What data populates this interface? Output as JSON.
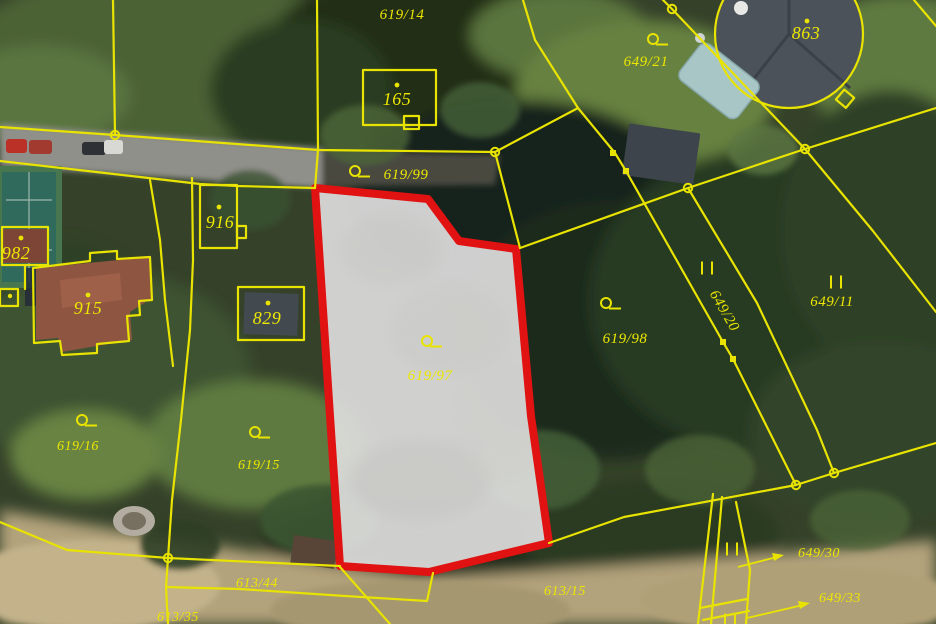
{
  "map_type": "cadastral-parcel-map-over-aerial-photo",
  "colors": {
    "parcel_line_yellow": "#e8e300",
    "label_yellow": "#ece600",
    "highlight_border_red": "#e01212",
    "highlight_fill": "#dddddb"
  },
  "highlight": {
    "parcel_number": "619/97"
  },
  "labels": [
    {
      "text": "619/14",
      "type": "parcel"
    },
    {
      "text": "165",
      "type": "building"
    },
    {
      "text": "649/21",
      "type": "parcel"
    },
    {
      "text": "863",
      "type": "building"
    },
    {
      "text": "619/99",
      "type": "parcel"
    },
    {
      "text": "916",
      "type": "building"
    },
    {
      "text": "982",
      "type": "building"
    },
    {
      "text": "915",
      "type": "building"
    },
    {
      "text": "829",
      "type": "building"
    },
    {
      "text": "619/98",
      "type": "parcel"
    },
    {
      "text": "649/20",
      "type": "parcel",
      "rotated": true
    },
    {
      "text": "649/11",
      "type": "parcel"
    },
    {
      "text": "619/97",
      "type": "parcel-highlighted"
    },
    {
      "text": "619/16",
      "type": "parcel"
    },
    {
      "text": "619/15",
      "type": "parcel"
    },
    {
      "text": "613/44",
      "type": "parcel"
    },
    {
      "text": "613/35",
      "type": "parcel"
    },
    {
      "text": "613/15",
      "type": "parcel"
    },
    {
      "text": "649/30",
      "type": "parcel"
    },
    {
      "text": "649/33",
      "type": "parcel"
    }
  ],
  "symbols": {
    "land_use_circle_bar": "circle with horizontal bar (land-use mark)",
    "double_bar": "II parallel marks (land-use mark)",
    "building_point": "small dot inside building outline",
    "boundary_node_circle": "open circle on boundary line",
    "boundary_node_square": "filled square on boundary line",
    "reference_arrow": "arrow from small parcel to its number"
  }
}
